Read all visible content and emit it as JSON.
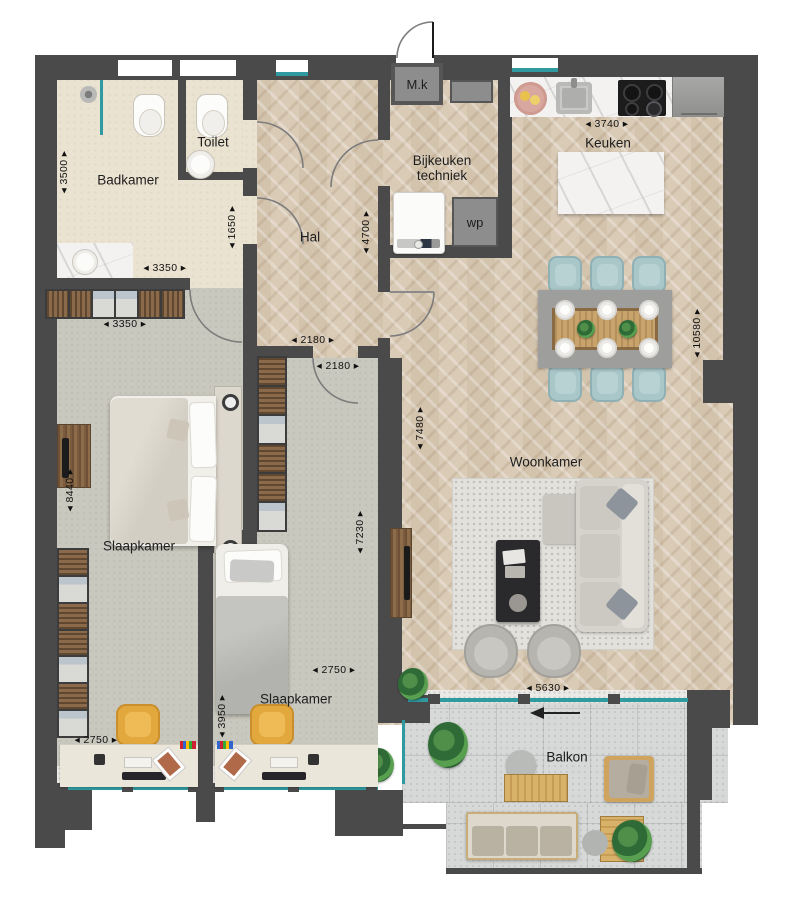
{
  "rooms": {
    "badkamer": {
      "label": "Badkamer"
    },
    "toilet": {
      "label": "Toilet"
    },
    "hal": {
      "label": "Hal"
    },
    "bijkeuken": {
      "label": "Bijkeuken techniek"
    },
    "keuken": {
      "label": "Keuken"
    },
    "woonkamer": {
      "label": "Woonkamer"
    },
    "slaapkamer_1": {
      "label": "Slaapkamer"
    },
    "slaapkamer_2": {
      "label": "Slaapkamer"
    },
    "balkon": {
      "label": "Balkon"
    }
  },
  "fixtures": {
    "meter_cupboard": "M.k",
    "heat_pump": "wp"
  },
  "dims": {
    "badkamer_height": "◂ 3500 ▸",
    "badkamer_width": "◂ 3350 ▸",
    "toilet_height": "◂ 1650 ▸",
    "hal_height": "◂ 4700 ▸",
    "keuken_width": "◂ 3740 ▸",
    "right_side_height": "◂ 10580 ▸",
    "hal_opening": "◂ 2180 ▸",
    "slaapkamer2_opening": "◂ 2180 ▸",
    "wardrobe_width": "◂ 3350 ▸",
    "slaapkamer1_height": "◂ 8440 ▸",
    "woonkamer_height": "◂ 7480 ▸",
    "slaapkamer2_height": "◂ 7230 ▸",
    "slaapkamer2_width": "◂ 2750 ▸",
    "woonkamer_width": "◂ 5630 ▸",
    "slaapkamer1_width": "◂ 2750 ▸",
    "slaapkamer2_lower_height": "◂ 3950 ▸"
  },
  "colors": {
    "wall": "#4a4a4b",
    "glass": "#2f9ba1",
    "wood_floor": "#d9cbb6",
    "bath_floor": "#ebe3d2",
    "bedroom_floor": "#c9c8be",
    "balcony_tile": "#d7d9d8",
    "dining_chair": "#a9c6c9",
    "desk_chair": "#e2a83e",
    "appliance_grey": "#8d8d8d"
  }
}
